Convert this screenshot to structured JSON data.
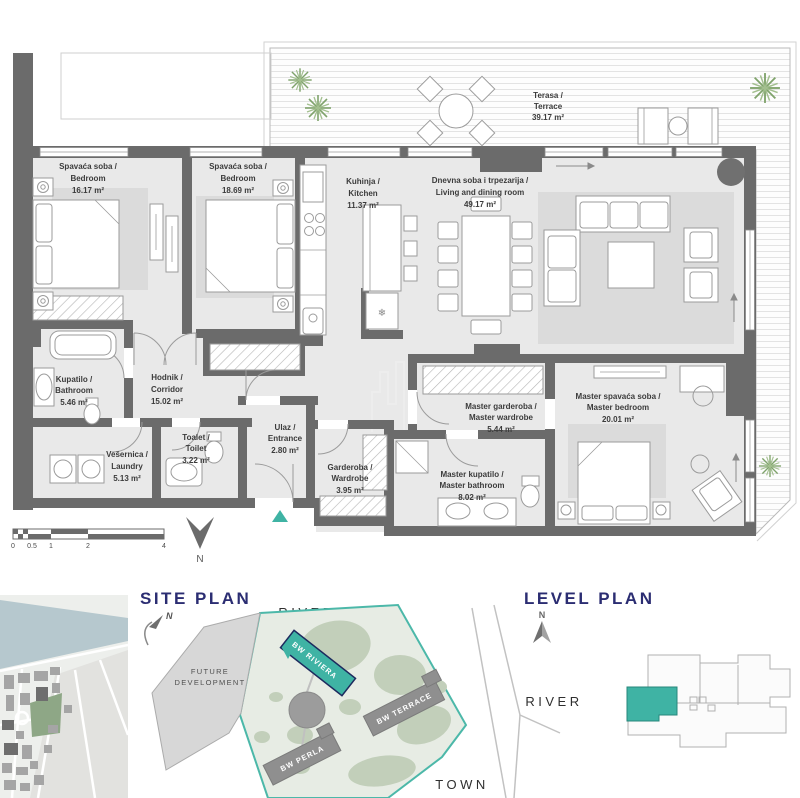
{
  "colors": {
    "accent_teal": "#3FB3A4",
    "heading_navy": "#2B2D72",
    "wall_gray": "#6B6B6B",
    "room_fill": "#E9E9E9",
    "rug_fill": "#DBDBDB"
  },
  "floor_plan": {
    "rooms": [
      {
        "name_local": "Spavaća soba /",
        "name_en": "Bedroom",
        "area": "16.17 m²"
      },
      {
        "name_local": "Spavaća soba /",
        "name_en": "Bedroom",
        "area": "18.69 m²"
      },
      {
        "name_local": "Kuhinja /",
        "name_en": "Kitchen",
        "area": "11.37 m²"
      },
      {
        "name_local": "Dnevna soba i trpezarija /",
        "name_en": "Living and dining room",
        "area": "49.17 m²"
      },
      {
        "name_local": "Terasa /",
        "name_en": "Terrace",
        "area": "39.17 m²"
      },
      {
        "name_local": "Kupatilo /",
        "name_en": "Bathroom",
        "area": "5.46 m²"
      },
      {
        "name_local": "Hodnik /",
        "name_en": "Corridor",
        "area": "15.02 m²"
      },
      {
        "name_local": "Toalet /",
        "name_en": "Toilet",
        "area": "3.22 m²"
      },
      {
        "name_local": "Vešernica /",
        "name_en": "Laundry",
        "area": "5.13 m²"
      },
      {
        "name_local": "Ulaz /",
        "name_en": "Entrance",
        "area": "2.80 m²"
      },
      {
        "name_local": "Garderoba /",
        "name_en": "Wardrobe",
        "area": "3.95 m²"
      },
      {
        "name_local": "Master garderoba /",
        "name_en": "Master wardrobe",
        "area": "5.44 m²"
      },
      {
        "name_local": "Master kupatilo /",
        "name_en": "Master bathroom",
        "area": "8.02 m²"
      },
      {
        "name_local": "Master spavaća soba /",
        "name_en": "Master bedroom",
        "area": "20.01 m²"
      }
    ],
    "scale_bar": {
      "ticks": [
        "0",
        "0.5",
        "1",
        "2",
        "4"
      ]
    },
    "north_label": "N",
    "freezer_icon": "❄"
  },
  "site_plan": {
    "heading": "SITE PLAN",
    "river_label": "RIVER",
    "town_label": "TOWN",
    "future_development_line1": "FUTURE",
    "future_development_line2": "DEVELOPMENT",
    "north_label": "N",
    "buildings": [
      {
        "name": "BW RIVIERA",
        "highlighted": true
      },
      {
        "name": "BW TERRACE",
        "highlighted": false
      },
      {
        "name": "BW PERLA",
        "highlighted": false
      }
    ]
  },
  "level_plan": {
    "heading": "LEVEL PLAN",
    "river_label": "RIVER",
    "north_label": "N"
  }
}
